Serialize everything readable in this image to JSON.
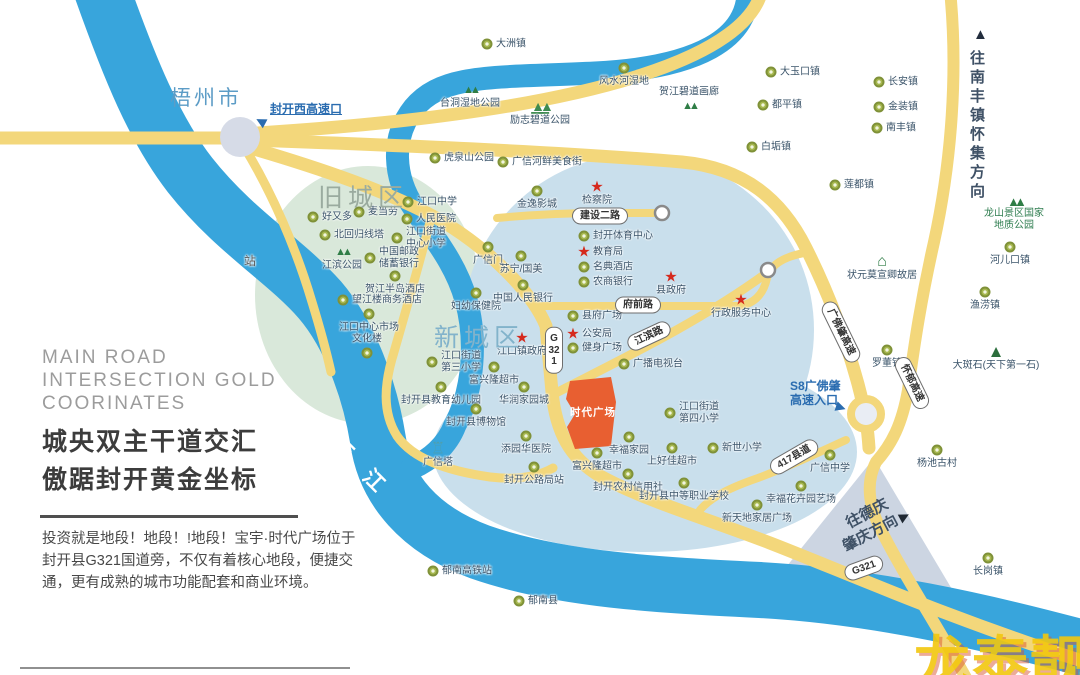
{
  "panel": {
    "title_en_line1": "MAIN ROAD",
    "title_en_line2": "INTERSECTION GOLD",
    "title_en_line3": "COORINATES",
    "title_cn_line1": "城央双主干道交汇",
    "title_cn_line2": "傲踞封开黄金坐标",
    "body": "投资就是地段！地段！!地段！宝宇·时代广场位于封开县G321国道旁，不仅有着核心地段，便捷交通，更有成熟的城市功能配套和商业环境。"
  },
  "map": {
    "labels": {
      "city": "梧州市",
      "river": "西 江",
      "old_town": "旧城区",
      "new_town": "新城区",
      "plaza": "时代广场",
      "west_entry": "封开西高速口",
      "s8_line1": "S8广佛肇",
      "s8_line2": "高速入口",
      "north_dir": "往南丰镇怀集方向",
      "se_dir1": "往德庆",
      "se_dir2": "肇庆方向",
      "geo_line1": "龙山景区国家",
      "geo_line2": "地质公园",
      "watermark": "龙泰靓房"
    },
    "colors": {
      "road": "#f3d77b",
      "river": "#38a5dc",
      "plaza": "#e85f31",
      "old_town_fill": "#d9e8da",
      "new_town_fill": "#c9dfec",
      "watermark": "#f2c70e"
    },
    "road_pills": [
      {
        "text": "建设二路",
        "x": 600,
        "y": 216,
        "rot": 0
      },
      {
        "text": "府前路",
        "x": 638,
        "y": 305,
        "rot": 0
      },
      {
        "text": "江滨路",
        "x": 649,
        "y": 336,
        "rot": -25
      },
      {
        "text": "G321",
        "x": 554,
        "y": 350,
        "rot": 0,
        "v": true
      },
      {
        "text": "417县道",
        "x": 794,
        "y": 457,
        "rot": -30
      },
      {
        "text": "广佛肇高速",
        "x": 841,
        "y": 332,
        "rot": 64
      },
      {
        "text": "怀郁高速",
        "x": 912,
        "y": 383,
        "rot": 64
      },
      {
        "text": "G321",
        "x": 864,
        "y": 568,
        "rot": -20
      }
    ],
    "markers": [
      {
        "t": "c",
        "x": 487,
        "y": 44,
        "l": "大洲镇",
        "lp": "r"
      },
      {
        "t": "c",
        "x": 624,
        "y": 68,
        "l": "风水河湿地",
        "lp": "b"
      },
      {
        "t": "c",
        "x": 771,
        "y": 72,
        "l": "大玉口镇",
        "lp": "r"
      },
      {
        "t": "c",
        "x": 879,
        "y": 82,
        "l": "长安镇",
        "lp": "r"
      },
      {
        "t": "c",
        "x": 763,
        "y": 105,
        "l": "都平镇",
        "lp": "r"
      },
      {
        "t": "c",
        "x": 879,
        "y": 107,
        "l": "金装镇",
        "lp": "r"
      },
      {
        "t": "c",
        "x": 877,
        "y": 128,
        "l": "南丰镇",
        "lp": "r"
      },
      {
        "t": "c",
        "x": 752,
        "y": 147,
        "l": "白垢镇",
        "lp": "r"
      },
      {
        "t": "c",
        "x": 835,
        "y": 185,
        "l": "莲都镇",
        "lp": "r"
      },
      {
        "t": "c",
        "x": 1010,
        "y": 247,
        "l": "河儿口镇",
        "lp": "b"
      },
      {
        "t": "c",
        "x": 985,
        "y": 292,
        "l": "渔涝镇",
        "lp": "b"
      },
      {
        "t": "c",
        "x": 887,
        "y": 350,
        "l": "罗董镇",
        "lp": "b"
      },
      {
        "t": "c",
        "x": 937,
        "y": 450,
        "l": "杨池古村",
        "lp": "b"
      },
      {
        "t": "c",
        "x": 830,
        "y": 455,
        "l": "广信中学",
        "lp": "b"
      },
      {
        "t": "c",
        "x": 988,
        "y": 558,
        "l": "长岗镇",
        "lp": "b"
      },
      {
        "t": "c",
        "x": 433,
        "y": 571,
        "l": "郁南高铁站",
        "lp": "r"
      },
      {
        "t": "c",
        "x": 519,
        "y": 601,
        "l": "郁南县",
        "lp": "r"
      },
      {
        "t": "c",
        "x": 801,
        "y": 486,
        "l": "幸福花卉园艺场",
        "lp": "b"
      },
      {
        "t": "c",
        "x": 757,
        "y": 505,
        "l": "新天地家居广场",
        "lp": "b"
      },
      {
        "t": "t2",
        "x": 470,
        "y": 90,
        "l": "台洞湿地公园",
        "lp": "b"
      },
      {
        "t": "pk",
        "x": 540,
        "y": 107,
        "l": "励志碧道公园",
        "lp": "b"
      },
      {
        "t": "t2",
        "x": 689,
        "y": 106,
        "l": "贺江碧道画廊",
        "lp": "a"
      },
      {
        "t": "m",
        "x": 996,
        "y": 352,
        "l": "大斑石(天下第一石)",
        "lp": "b"
      },
      {
        "t": "bd",
        "x": 882,
        "y": 262,
        "l": "状元莫宣卿故居",
        "lp": "b"
      },
      {
        "t": "pg",
        "x": 438,
        "y": 449,
        "l": "广信塔",
        "lp": "b"
      },
      {
        "t": "t2",
        "x": 342,
        "y": 252,
        "l": "江滨公园",
        "lp": "b"
      },
      {
        "t": "c",
        "x": 435,
        "y": 158,
        "l": "虎泉山公园",
        "lp": "r"
      },
      {
        "t": "c",
        "x": 503,
        "y": 162,
        "l": "广信河鲜美食街",
        "lp": "r"
      },
      {
        "t": "c",
        "x": 313,
        "y": 217,
        "l": "好又多",
        "lp": "r"
      },
      {
        "t": "c",
        "x": 359,
        "y": 212,
        "l": "麦当劳",
        "lp": "r"
      },
      {
        "t": "c",
        "x": 408,
        "y": 202,
        "l": "江口中学",
        "lp": "r"
      },
      {
        "t": "c",
        "x": 407,
        "y": 219,
        "l": "人民医院",
        "lp": "r"
      },
      {
        "t": "c",
        "x": 325,
        "y": 235,
        "l": "北回归线塔",
        "lp": "r"
      },
      {
        "t": "c",
        "x": 397,
        "y": 238,
        "l": "江口街道",
        "l2": "中心小学",
        "lp": "r"
      },
      {
        "t": "c",
        "x": 370,
        "y": 258,
        "l": "中国邮政",
        "l2": "储蓄银行",
        "lp": "r"
      },
      {
        "t": "c",
        "x": 395,
        "y": 276,
        "l": "贺江半岛酒店",
        "lp": "b"
      },
      {
        "t": "c",
        "x": 343,
        "y": 300,
        "l": "望江楼商务酒店",
        "lp": "r"
      },
      {
        "t": "c",
        "x": 369,
        "y": 314,
        "l": "江口中心市场",
        "lp": "b"
      },
      {
        "t": "c",
        "x": 367,
        "y": 353,
        "l": "文化楼",
        "lp": "a"
      },
      {
        "t": "tx",
        "x": 250,
        "y": 262,
        "l": "站",
        "lp": "c"
      },
      {
        "t": "c",
        "x": 537,
        "y": 191,
        "l": "金逸影城",
        "lp": "b"
      },
      {
        "t": "s",
        "x": 597,
        "y": 187,
        "l": "检察院",
        "lp": "b"
      },
      {
        "t": "c",
        "x": 584,
        "y": 236,
        "l": "封开体育中心",
        "lp": "r"
      },
      {
        "t": "s",
        "x": 584,
        "y": 252,
        "l": "教育局",
        "lp": "r"
      },
      {
        "t": "c",
        "x": 584,
        "y": 267,
        "l": "名典酒店",
        "lp": "r"
      },
      {
        "t": "c",
        "x": 584,
        "y": 282,
        "l": "农商银行",
        "lp": "r"
      },
      {
        "t": "s",
        "x": 671,
        "y": 277,
        "l": "县政府",
        "lp": "b"
      },
      {
        "t": "s",
        "x": 741,
        "y": 300,
        "l": "行政服务中心",
        "lp": "b"
      },
      {
        "t": "c",
        "x": 573,
        "y": 316,
        "l": "县府广场",
        "lp": "r"
      },
      {
        "t": "s",
        "x": 573,
        "y": 334,
        "l": "公安局",
        "lp": "r"
      },
      {
        "t": "c",
        "x": 573,
        "y": 348,
        "l": "健身广场",
        "lp": "r"
      },
      {
        "t": "c",
        "x": 624,
        "y": 364,
        "l": "广播电视台",
        "lp": "r"
      },
      {
        "t": "c",
        "x": 488,
        "y": 247,
        "l": "广信门",
        "lp": "b"
      },
      {
        "t": "c",
        "x": 521,
        "y": 256,
        "l": "苏宁/国美",
        "lp": "b"
      },
      {
        "t": "c",
        "x": 523,
        "y": 285,
        "l": "中国人民银行",
        "lp": "b"
      },
      {
        "t": "c",
        "x": 476,
        "y": 293,
        "l": "妇幼保健院",
        "lp": "b"
      },
      {
        "t": "s",
        "x": 522,
        "y": 338,
        "l": "江口镇政府",
        "lp": "b"
      },
      {
        "t": "c",
        "x": 432,
        "y": 362,
        "l": "江口街道",
        "l2": "第三小学",
        "lp": "r"
      },
      {
        "t": "c",
        "x": 494,
        "y": 367,
        "l": "富兴隆超市",
        "lp": "b"
      },
      {
        "t": "c",
        "x": 441,
        "y": 387,
        "l": "封开县教育幼儿园",
        "lp": "b"
      },
      {
        "t": "c",
        "x": 524,
        "y": 387,
        "l": "华润家园城",
        "lp": "b"
      },
      {
        "t": "c",
        "x": 476,
        "y": 409,
        "l": "封开县博物馆",
        "lp": "b"
      },
      {
        "t": "c",
        "x": 526,
        "y": 436,
        "l": "添园华医院",
        "lp": "b"
      },
      {
        "t": "c",
        "x": 534,
        "y": 467,
        "l": "封开公路局站",
        "lp": "b"
      },
      {
        "t": "c",
        "x": 670,
        "y": 413,
        "l": "江口街道",
        "l2": "第四小学",
        "lp": "r"
      },
      {
        "t": "c",
        "x": 597,
        "y": 453,
        "l": "富兴隆超市",
        "lp": "b"
      },
      {
        "t": "c",
        "x": 629,
        "y": 437,
        "l": "幸福家园",
        "lp": "b"
      },
      {
        "t": "c",
        "x": 672,
        "y": 448,
        "l": "上好佳超市",
        "lp": "b"
      },
      {
        "t": "c",
        "x": 713,
        "y": 448,
        "l": "新世小学",
        "lp": "r"
      },
      {
        "t": "c",
        "x": 628,
        "y": 474,
        "l": "封开农村信用社",
        "lp": "b"
      },
      {
        "t": "c",
        "x": 684,
        "y": 483,
        "l": "封开县中等职业学校",
        "lp": "b"
      }
    ]
  }
}
